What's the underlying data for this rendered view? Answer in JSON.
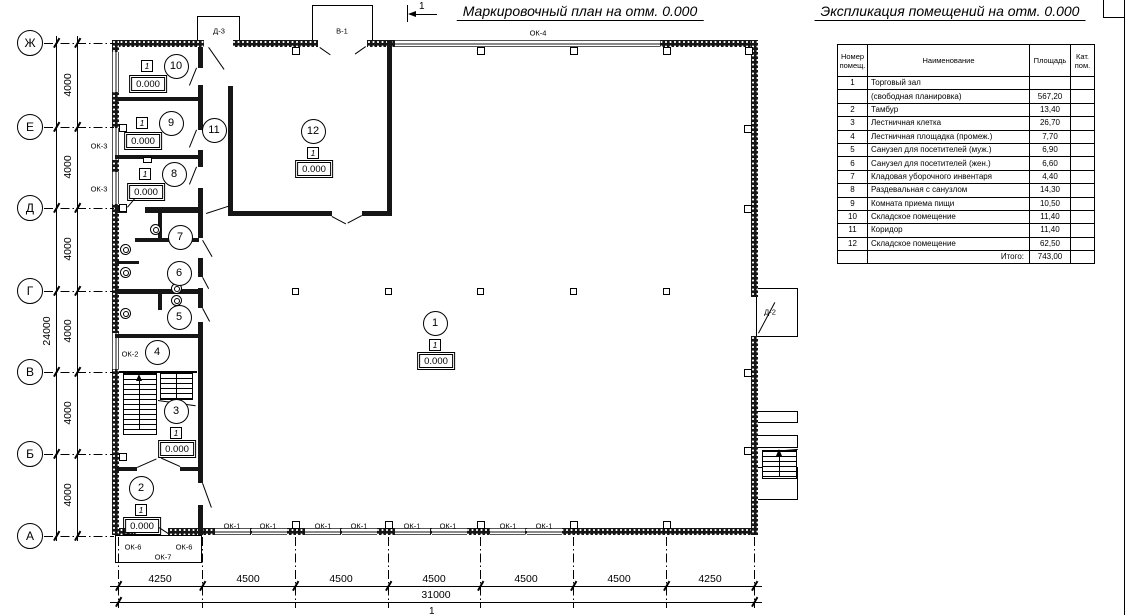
{
  "titles": {
    "plan": "Маркировочный план на отм. 0.000",
    "explication": "Экспликация помещений на отм. 0.000",
    "section_mark": "1"
  },
  "plan": {
    "level_note": "0.000",
    "bottom_axis_mark": "1",
    "axes_rows": [
      {
        "label": "Ж",
        "y": 43
      },
      {
        "label": "Е",
        "y": 127
      },
      {
        "label": "Д",
        "y": 208
      },
      {
        "label": "Г",
        "y": 291
      },
      {
        "label": "В",
        "y": 372
      },
      {
        "label": "Б",
        "y": 454
      },
      {
        "label": "А",
        "y": 536
      }
    ],
    "dim_left_segments": [
      {
        "text": "4000",
        "y": 85
      },
      {
        "text": "4000",
        "y": 167
      },
      {
        "text": "4000",
        "y": 249
      },
      {
        "text": "4000",
        "y": 331
      },
      {
        "text": "4000",
        "y": 413
      },
      {
        "text": "4000",
        "y": 495
      }
    ],
    "dim_left_total": {
      "text": "24000",
      "x": 47,
      "y": 331
    },
    "grid_cols_x": [
      118,
      202,
      295,
      388,
      480,
      573,
      666,
      754
    ],
    "dim_bottom_segments": [
      {
        "text": "4250",
        "x": 160
      },
      {
        "text": "4500",
        "x": 248
      },
      {
        "text": "4500",
        "x": 341
      },
      {
        "text": "4500",
        "x": 434
      },
      {
        "text": "4500",
        "x": 526
      },
      {
        "text": "4500",
        "x": 619
      },
      {
        "text": "4250",
        "x": 710
      }
    ],
    "dim_bottom_total": {
      "text": "31000",
      "x": 436
    },
    "rooms": [
      {
        "num": "10",
        "cx": 176,
        "cy": 66,
        "marker": true,
        "layout": "side",
        "mark": "1",
        "level": "0.000"
      },
      {
        "num": "9",
        "cx": 171,
        "cy": 123,
        "marker": true,
        "layout": "side",
        "mark": "1",
        "level": "0.000"
      },
      {
        "num": "11",
        "cx": 214,
        "cy": 130,
        "marker": false
      },
      {
        "num": "8",
        "cx": 174,
        "cy": 174,
        "marker": true,
        "layout": "side",
        "mark": "1",
        "level": "0.000"
      },
      {
        "num": "12",
        "cx": 313,
        "cy": 131,
        "marker": true,
        "layout": "stack",
        "mark": "1",
        "level": "0.000"
      },
      {
        "num": "7",
        "cx": 180,
        "cy": 237,
        "marker": false
      },
      {
        "num": "6",
        "cx": 179,
        "cy": 273,
        "marker": false
      },
      {
        "num": "5",
        "cx": 179,
        "cy": 317,
        "marker": false
      },
      {
        "num": "4",
        "cx": 157,
        "cy": 352,
        "marker": false
      },
      {
        "num": "1",
        "cx": 435,
        "cy": 323,
        "marker": true,
        "layout": "stack",
        "mark": "1",
        "level": "0.000"
      },
      {
        "num": "3",
        "cx": 176,
        "cy": 411,
        "marker": true,
        "layout": "stack",
        "mark": "1",
        "level": "0.000"
      },
      {
        "num": "2",
        "cx": 141,
        "cy": 488,
        "marker": true,
        "layout": "stack",
        "mark": "1",
        "level": "0.000"
      }
    ],
    "opening_labels": [
      {
        "text": "ОК-4",
        "x": 538,
        "y": 33
      },
      {
        "text": "Д-3",
        "x": 219,
        "y": 31
      },
      {
        "text": "В-1",
        "x": 342,
        "y": 31
      },
      {
        "text": "ОК-3",
        "x": 99,
        "y": 146
      },
      {
        "text": "ОК-3",
        "x": 99,
        "y": 189
      },
      {
        "text": "ОК-2",
        "x": 130,
        "y": 354
      },
      {
        "text": "Д-2",
        "x": 770,
        "y": 312
      },
      {
        "text": "Д-1",
        "x": 150,
        "y": 522
      },
      {
        "text": "ОК-6",
        "x": 133,
        "y": 547
      },
      {
        "text": "ОК-6",
        "x": 184,
        "y": 547
      },
      {
        "text": "ОК-7",
        "x": 163,
        "y": 557
      },
      {
        "text": "ОК-1",
        "x": 232,
        "y": 526
      },
      {
        "text": "ОК-1",
        "x": 268,
        "y": 526
      },
      {
        "text": "ОК-1",
        "x": 323,
        "y": 526
      },
      {
        "text": "ОК-1",
        "x": 359,
        "y": 526
      },
      {
        "text": "ОК-1",
        "x": 412,
        "y": 526
      },
      {
        "text": "ОК-1",
        "x": 448,
        "y": 526
      },
      {
        "text": "ОК-1",
        "x": 508,
        "y": 526
      },
      {
        "text": "ОК-1",
        "x": 544,
        "y": 526
      }
    ]
  },
  "explication": {
    "table": {
      "headers": [
        "Номер помещ.",
        "Наименование",
        "Площадь",
        "Кат. пом."
      ],
      "rows": [
        [
          "1",
          "Торговый зал",
          "",
          ""
        ],
        [
          "",
          "(свободная планировка)",
          "567,20",
          ""
        ],
        [
          "2",
          "Тамбур",
          "13,40",
          ""
        ],
        [
          "3",
          "Лестничная клетка",
          "26,70",
          ""
        ],
        [
          "4",
          "Лестничная площадка (промеж.)",
          "7,70",
          ""
        ],
        [
          "5",
          "Санузел для посетителей (муж.)",
          "6,90",
          ""
        ],
        [
          "6",
          "Санузел для посетителей (жен.)",
          "6,60",
          ""
        ],
        [
          "7",
          "Кладовая уборочного инвентаря",
          "4,40",
          ""
        ],
        [
          "8",
          "Раздевальная с санузлом",
          "14,30",
          ""
        ],
        [
          "9",
          "Комната приема пищи",
          "10,50",
          ""
        ],
        [
          "10",
          "Складское помещение",
          "11,40",
          ""
        ],
        [
          "11",
          "Коридор",
          "11,40",
          ""
        ],
        [
          "12",
          "Складское помещение",
          "62,50",
          ""
        ],
        [
          "",
          "Итого:",
          "743,00",
          ""
        ]
      ]
    }
  }
}
